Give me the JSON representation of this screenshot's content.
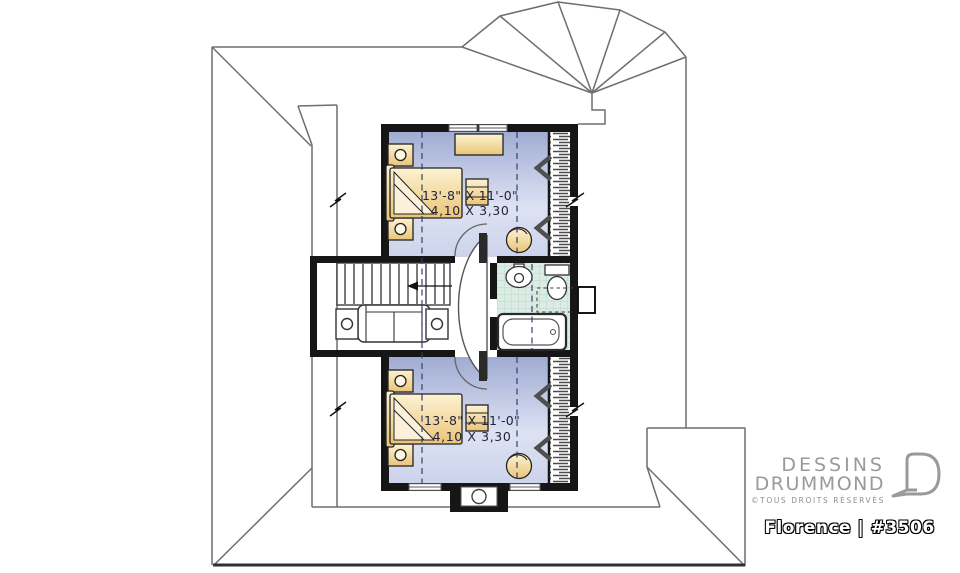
{
  "branding": {
    "name_line1": "DESSINS",
    "name_line2": "DRUMMOND",
    "rights": "©TOUS DROITS RÉSERVÉS",
    "model": "Florence | #3506"
  },
  "rooms": {
    "bedroom_upper": {
      "dim_imperial": "13'-8\" X 11'-0\"",
      "dim_metric": "4,10 X 3,30"
    },
    "bedroom_lower": {
      "dim_imperial": "13'-8\" X 11'-0\"",
      "dim_metric": "4,10 X 3,30"
    }
  },
  "icons": {
    "bed": "double-bed with fold-back cover",
    "nightstand": "night table with lamp",
    "dresser": "dresser",
    "chest": "chest of drawers",
    "armchair": "corner armchair",
    "sofa": "sofa with end tables",
    "stairs": "staircase with down arrow",
    "sink": "pedestal sink",
    "toilet": "toilet",
    "bathtub": "bathtub",
    "access_door": "attic knee-wall access chevron",
    "round_window": "round window"
  },
  "colors": {
    "wall": "#161616",
    "bedroom_floor_top": "#9fabd2",
    "bedroom_floor_mid": "#dde2f3",
    "bedroom_floor_bottom": "#cdd3eb",
    "furniture_light": "#fdf2d2",
    "furniture_dark": "#eac578",
    "bathroom_floor": "#daece4",
    "bathroom_grid": "#bcd7ca",
    "roof_line": "#6e6e6e",
    "dashed_ceiling_line": "#33406e",
    "brand_gray": "#9a9a9a"
  }
}
